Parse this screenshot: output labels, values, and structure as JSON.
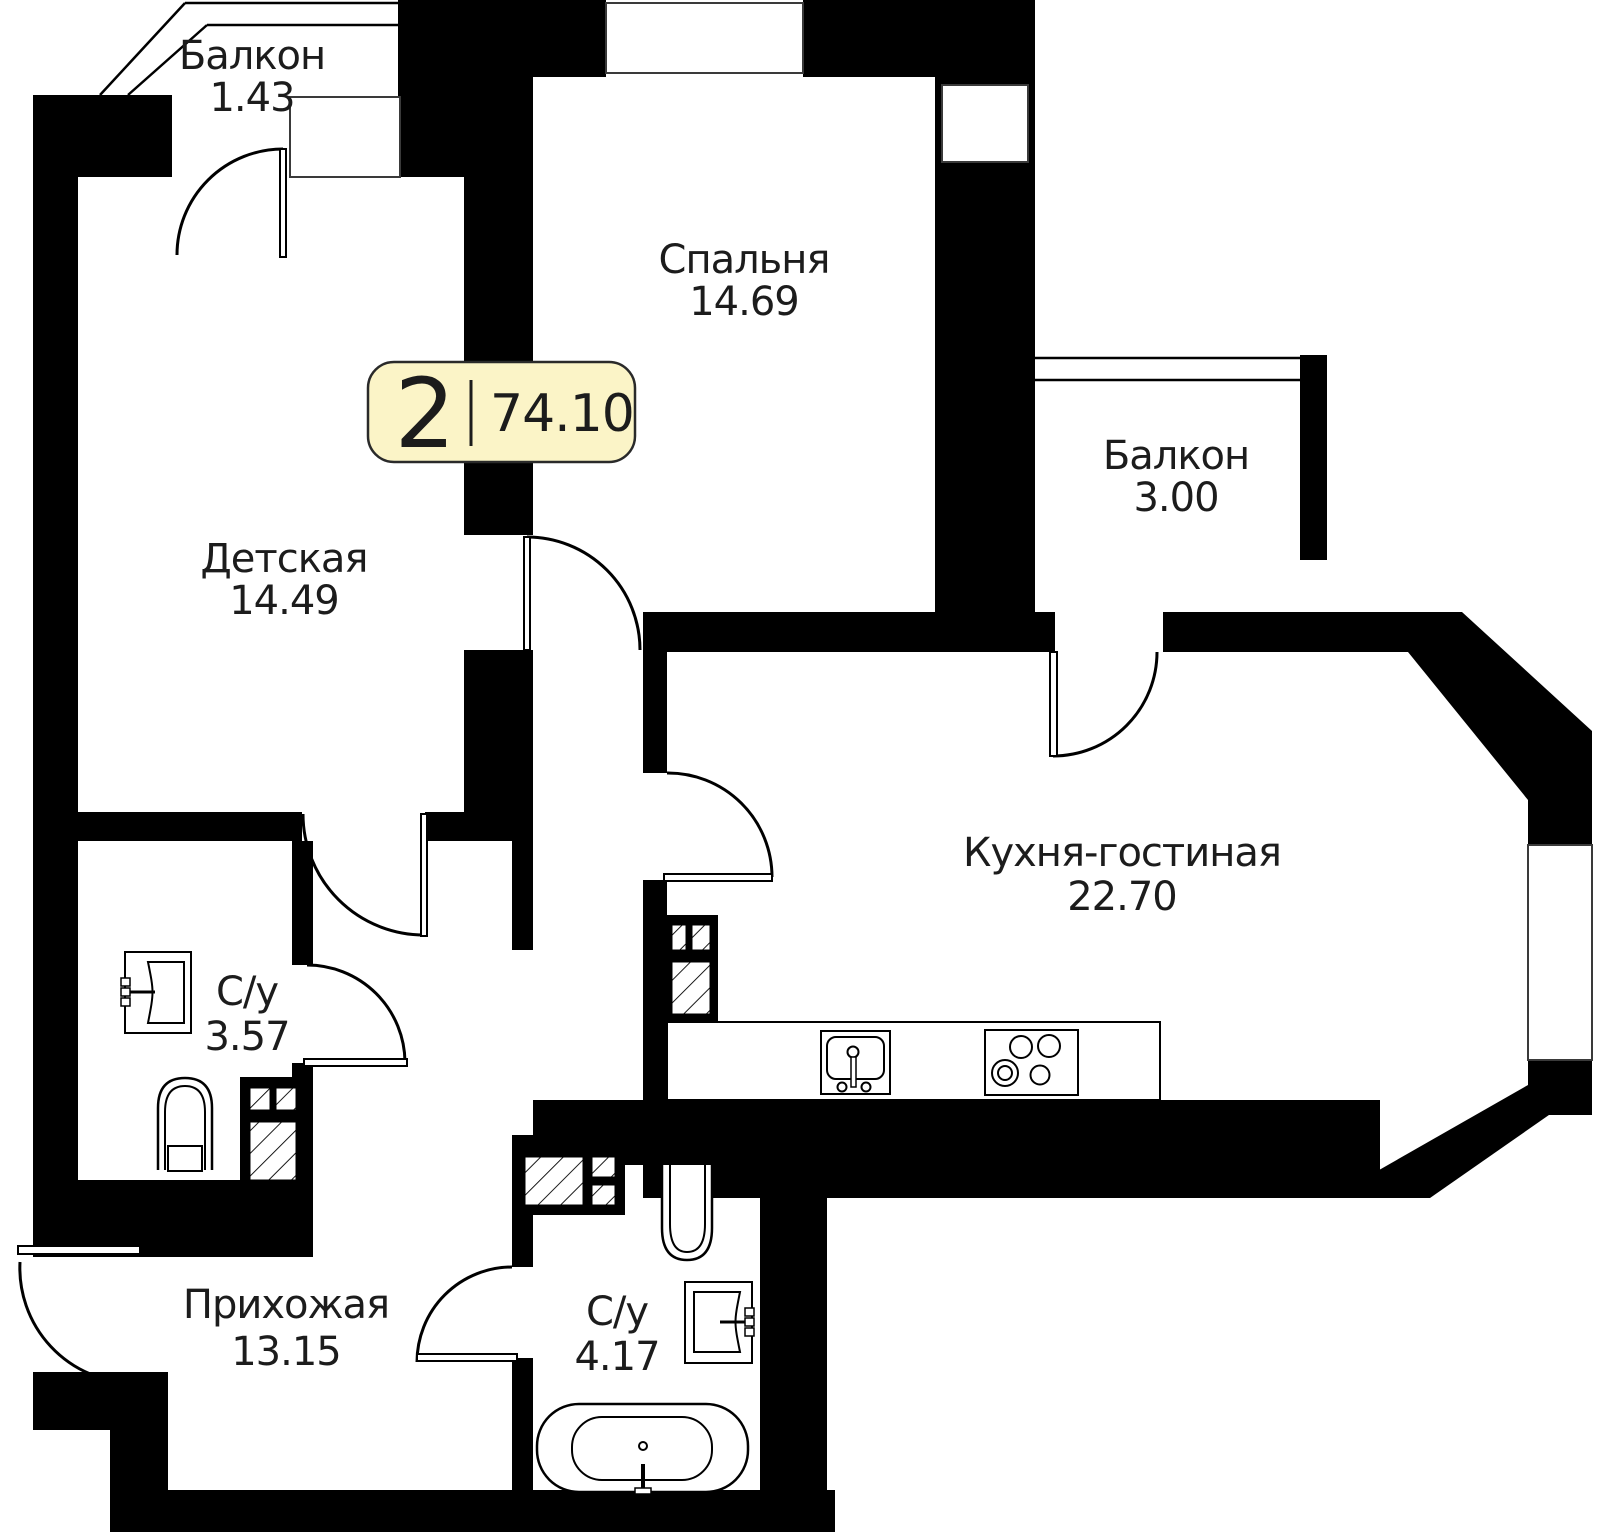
{
  "plan": {
    "badge": {
      "rooms": "2",
      "area": "74.10"
    },
    "rooms": [
      {
        "id": "balcony-top",
        "name": "Балкон",
        "area": "1.43"
      },
      {
        "id": "bedroom",
        "name": "Спальня",
        "area": "14.69"
      },
      {
        "id": "balcony-right",
        "name": "Балкон",
        "area": "3.00"
      },
      {
        "id": "kids-room",
        "name": "Детская",
        "area": "14.49"
      },
      {
        "id": "kitchen",
        "name": "Кухня-гостиная",
        "area": "22.70"
      },
      {
        "id": "bath-small",
        "name": "С/у",
        "area": "3.57"
      },
      {
        "id": "hallway",
        "name": "Прихожая",
        "area": "13.15"
      },
      {
        "id": "bath-big",
        "name": "С/у",
        "area": "4.17"
      }
    ],
    "icons": [
      "door-arc-icon",
      "window-icon",
      "vent-shaft-hatch-icon",
      "sink-icon",
      "toilet-icon",
      "bathtub-icon",
      "stove-icon",
      "kitchen-sink-icon"
    ],
    "colors": {
      "wall": "#000000",
      "badge_bg": "#FBF4C7",
      "badge_border": "#2a2a2a",
      "text": "#1c1c1c"
    }
  }
}
